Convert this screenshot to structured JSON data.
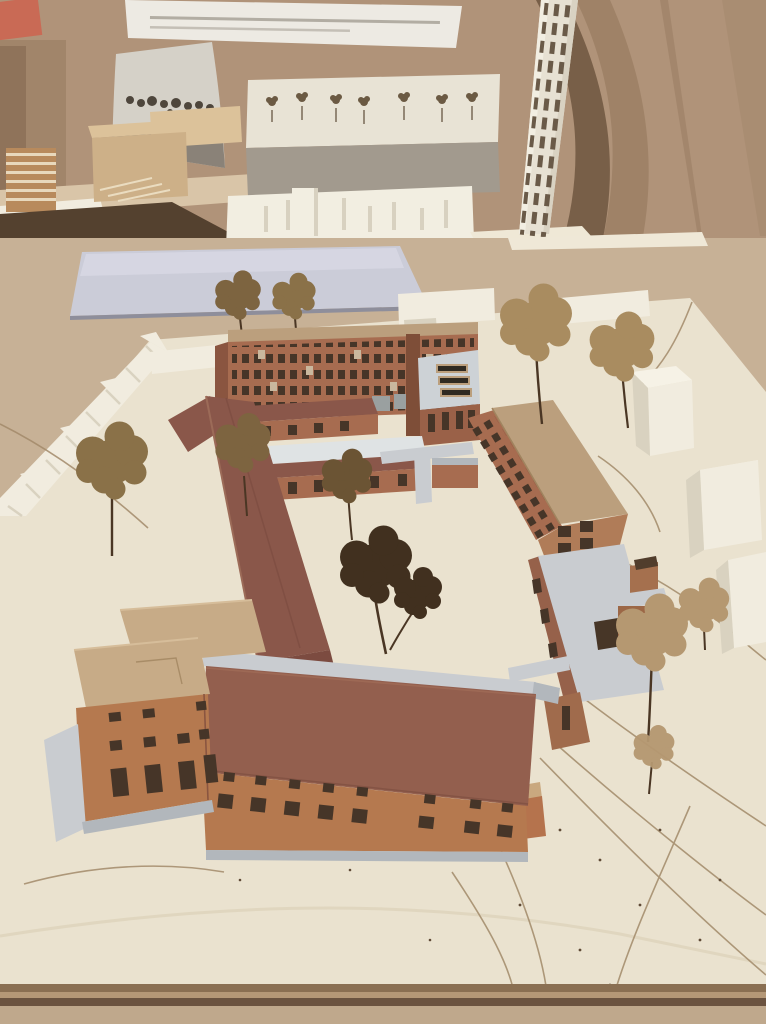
{
  "image_type": "photograph",
  "subject": "architectural cardboard site model on a studio table, kraft-paper backdrop",
  "scene": {
    "background": [
      "kraft-paper-wall",
      "pinned-note-paper",
      "red-card",
      "curved-photo-print",
      "wood-massing-blocks",
      "street-model-with-trees",
      "white-city-massing-model",
      "white-perforated-tower",
      "tower-shadow"
    ],
    "midground": [
      "table-surface",
      "lavender-paper-sheet"
    ],
    "site_model": [
      "cream-baseboard",
      "back-terracotta-building",
      "gray-roof-annex-with-skylights",
      "right-corrugated-building-tan-roof",
      "gray-roof-wing-with-tower",
      "maroon-monopitch-wing",
      "courtyard-pavilions",
      "foreground-l-shaped-building",
      "foreground-red-roof-building",
      "white-context-blocks",
      "engraved-road-lines",
      "dried-plant-trees"
    ]
  },
  "palette": {
    "wall": "#b09379",
    "wallDark": "#a1856a",
    "wallDarker": "#8f735a",
    "wallShadow": "#6e5640",
    "wallShadow2": "#8d7155",
    "table": "#c7b196",
    "tableShadow": "#54412f",
    "board": "#d9c5a8",
    "wood": "#cdb088",
    "woodLight": "#dcc29a",
    "note": "#edeae3",
    "noteLine": "#b2ada3",
    "redCard": "#c96a55",
    "photo": "#d5d1c8",
    "photoDark": "#4e463c",
    "photoMid": "#8a8278",
    "slabWhite": "#e8e3d5",
    "slabGray": "#a29a8e",
    "massing": "#f2eee1",
    "massingShade": "#d8d1c0",
    "tower": "#e7e1d3",
    "towerLight": "#f2eee2",
    "towerShade": "#d9d2c2",
    "towerWin": "#6a5a48",
    "towerBase": "#efe8d6",
    "paper": "#cbccd8",
    "paperLight": "#d6d6e2",
    "paperEdge": "#8e8e9b",
    "base": "#eae2cf",
    "baseLight": "#efe8d7",
    "baseCurve": "#dfd5bd",
    "terra": "#a76c50",
    "terraDark": "#8a5540",
    "terraLight": "#b5794f",
    "cardTan": "#bb9f7d",
    "cardTan2": "#c7ab87",
    "cardEdge": "#a0845f",
    "maroon": "#8a574a",
    "maroonDark": "#7c4b40",
    "maroonHi": "#9c6b58",
    "roofRed": "#935f4e",
    "win": "#463528",
    "glass": "#9aa0a0",
    "winLite": "#c9b89e",
    "gray": "#c9ccd0",
    "grayDark": "#b2b7bc",
    "contextWhite": "#f1ecdf",
    "contextShade": "#d9d2c0",
    "treeDark": "#41301f",
    "treeOlive": "#8a7148",
    "treeOlive2": "#7d6440",
    "treeOlive3": "#6b5434",
    "treeTan": "#a98c60",
    "treeFluff": "#b59871",
    "treeTiny": "#6b5a43",
    "trunk": "#4a3624",
    "line": "#a28a6a",
    "dot": "#5f4a36",
    "edge1": "#8a6f52",
    "edge2": "#b59877",
    "edge3": "#6b5340",
    "tableFront": "#bfa88c"
  }
}
